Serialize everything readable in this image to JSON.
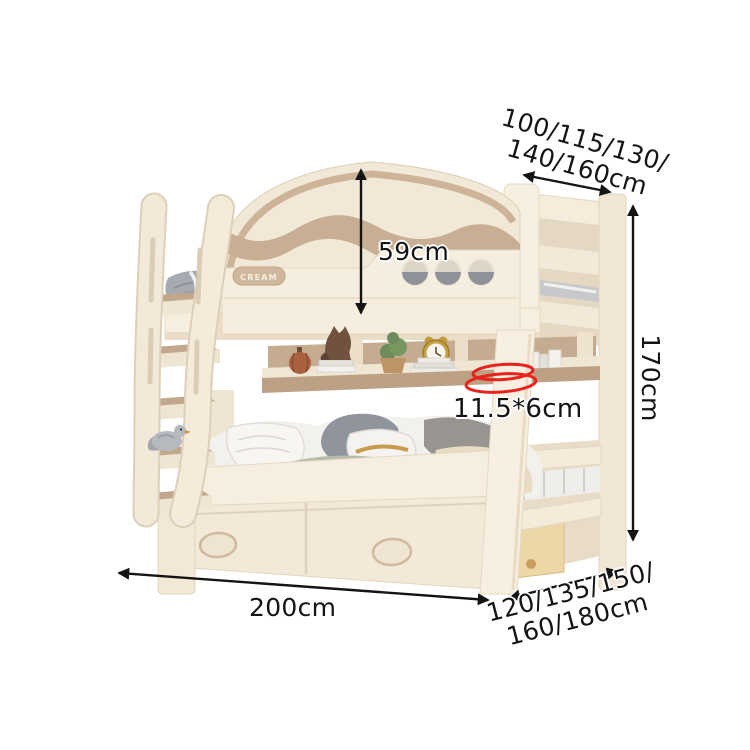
{
  "page": {
    "background": "#ffffff"
  },
  "product": {
    "brand_badge": "CREAM"
  },
  "annotations": {
    "upper_width": {
      "line1": "100/115/130/",
      "line2": "140/160cm"
    },
    "headboard_height": {
      "label": "59cm"
    },
    "overall_height": {
      "label": "170cm"
    },
    "post_size": {
      "label": "11.5*6cm"
    },
    "bed_length": {
      "label": "200cm"
    },
    "lower_width": {
      "line1": "120/135/150/",
      "line2": "160/180cm"
    }
  },
  "colors": {
    "annotation-text": "#141414",
    "arrow-ink": "#141414",
    "highlight-red": "#e8231d",
    "bed-cream": "#f4ebdb",
    "bed-cream-shadow": "#e5d8c3",
    "accent-tan": "#c8ae93",
    "bedding-gray": "#90949c",
    "bedding-sage": "#b6bca9",
    "bedding-beige": "#e9dcc5",
    "drawer-wood": "#ecd7a7"
  }
}
